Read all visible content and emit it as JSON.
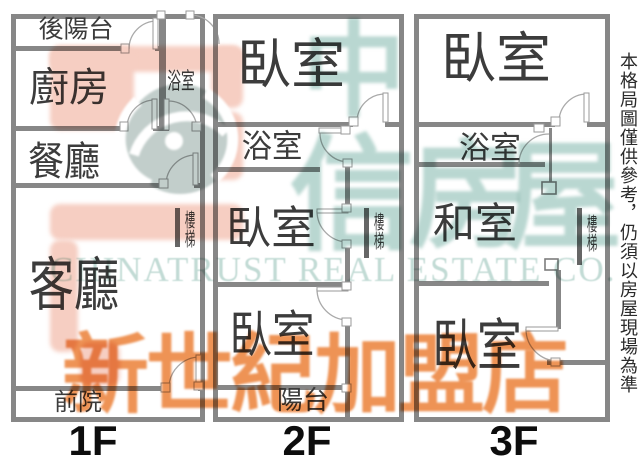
{
  "canvas": {
    "w": 638,
    "h": 460
  },
  "colors": {
    "wall": "#878787",
    "stair_bar": "#666666",
    "door_line": "#a9a9a9",
    "room_text": "#3c3c3c",
    "floor_text": "#0d0d0d",
    "pink": "#f6cec2",
    "teal_char": "#b9d7d1",
    "teal_text": "#c2dbd5",
    "globe": "#c2cecb",
    "orange": "#ee9355",
    "disclaimer_text": "#2b2b2b"
  },
  "disclaimer": {
    "text": "本格局圖僅供參考，仍須以房屋現場為準"
  },
  "watermark": {
    "english": "CHINATRUST REAL ESTATE CO.",
    "franchise": "新世紀加盟店",
    "brand_chars": [
      {
        "ch": "中",
        "x": 354,
        "y": 72,
        "size": 104
      },
      {
        "ch": "信",
        "x": 352,
        "y": 196,
        "size": 125
      },
      {
        "ch": "房",
        "x": 468,
        "y": 197,
        "size": 118
      },
      {
        "ch": "屋",
        "x": 563,
        "y": 198,
        "size": 118
      }
    ],
    "pink_shapes": [
      [
        50,
        46,
        193,
        26
      ],
      [
        50,
        46,
        84,
        84
      ],
      [
        211,
        46,
        32,
        62
      ],
      [
        211,
        112,
        32,
        68
      ],
      [
        50,
        204,
        193,
        36
      ],
      [
        50,
        240,
        28,
        112
      ],
      [
        80,
        342,
        40,
        44
      ]
    ],
    "globe": {
      "cx": 180,
      "cy": 139,
      "r": 55
    }
  },
  "floors": [
    {
      "label": "1F",
      "label_x": 93,
      "label_y": 441,
      "walls": [
        [
          11,
          14,
          194,
          5
        ],
        [
          11,
          417,
          194,
          5
        ],
        [
          11,
          14,
          5,
          408
        ],
        [
          200,
          14,
          5,
          408
        ],
        [
          11,
          46,
          117,
          5
        ],
        [
          155,
          46,
          11,
          5
        ],
        [
          159,
          14,
          7,
          117
        ],
        [
          11,
          126,
          113,
          5
        ],
        [
          153,
          126,
          16,
          5
        ],
        [
          196,
          126,
          9,
          5
        ],
        [
          11,
          183,
          152,
          5
        ],
        [
          194,
          183,
          11,
          5
        ],
        [
          11,
          386,
          155,
          5
        ],
        [
          198,
          386,
          7,
          5
        ]
      ],
      "stair_bar": [
        175,
        208,
        5,
        39
      ],
      "doors": [
        {
          "arc": [
            129,
            49,
            28,
            157,
            21,
            1
          ],
          "leaf": [
            153,
            18,
            5,
            31
          ],
          "jambs": [
            [
              121,
              44,
              8,
              9
            ]
          ]
        },
        {
          "arc": [
            190,
            15,
            29,
            219,
            44,
            1
          ],
          "jambs": [
            [
              157,
              11,
              8,
              8
            ],
            [
              186,
              11,
              8,
              8
            ]
          ]
        },
        {
          "arc": [
            127,
            128,
            28,
            155,
            100,
            1
          ],
          "leaf": [
            152,
            99,
            5,
            30
          ],
          "jambs": [
            [
              120,
              122,
              8,
              9
            ]
          ]
        },
        {
          "arc": [
            168,
            101,
            29,
            197,
            130,
            1
          ],
          "leaf": [
            164,
            99,
            5,
            31
          ],
          "jambs": [
            [
              192,
              122,
              9,
              9
            ]
          ]
        },
        {
          "arc": [
            166,
            185,
            30,
            196,
            155,
            1
          ],
          "leaf": [
            193,
            153,
            5,
            32
          ],
          "jambs": [
            [
              159,
              179,
              9,
              9
            ]
          ]
        },
        {
          "arc": [
            169,
            388,
            31,
            200,
            357,
            1
          ],
          "leaf": [
            196,
            355,
            5,
            32
          ],
          "jambs": [
            [
              161,
              383,
              9,
              9
            ],
            [
              194,
              382,
              9,
              8
            ]
          ]
        }
      ],
      "labels": [
        {
          "name": "back-balcony",
          "text": "後陽台",
          "x": 76,
          "y": 30,
          "size": 25
        },
        {
          "name": "kitchen",
          "text": "廚房",
          "x": 69,
          "y": 88,
          "size": 40
        },
        {
          "name": "bathroom",
          "text": "浴室",
          "x": 181,
          "y": 81,
          "size": 23,
          "sx": 0.6
        },
        {
          "name": "dining-room",
          "text": "餐廳",
          "x": 64,
          "y": 162,
          "size": 40,
          "sx": 0.9
        },
        {
          "name": "stairs",
          "text": "樓梯",
          "x": 189,
          "y": 229,
          "size": 19,
          "vertical": true,
          "sx": 0.55
        },
        {
          "name": "living-room",
          "text": "客廳",
          "x": 74,
          "y": 286,
          "size": 58,
          "sx": 0.78
        },
        {
          "name": "front-yard",
          "text": "前院",
          "x": 78,
          "y": 403,
          "size": 24
        }
      ]
    },
    {
      "label": "2F",
      "label_x": 307,
      "label_y": 441,
      "walls": [
        [
          213,
          14,
          191,
          5
        ],
        [
          213,
          417,
          191,
          5
        ],
        [
          213,
          14,
          5,
          408
        ],
        [
          399,
          14,
          5,
          408
        ],
        [
          213,
          122,
          140,
          5
        ],
        [
          385,
          122,
          19,
          5
        ],
        [
          213,
          167,
          107,
          5
        ],
        [
          345,
          167,
          5,
          43
        ],
        [
          345,
          246,
          5,
          42
        ],
        [
          345,
          324,
          5,
          93
        ],
        [
          218,
          282,
          131,
          5
        ],
        [
          218,
          385,
          131,
          5
        ]
      ],
      "stair_bar": [
        364,
        208,
        5,
        50
      ],
      "doors": [
        {
          "arc": [
            357,
            122,
            28,
            385,
            94,
            1
          ],
          "leaf": [
            383,
            93,
            5,
            29
          ],
          "jambs": [
            [
              349,
              117,
              9,
              9
            ]
          ]
        },
        {
          "arc": [
            320,
            133,
            29,
            349,
            162,
            0
          ],
          "leaf": [
            319,
            128,
            30,
            5
          ],
          "jambs": [
            [
              341,
              126,
              9,
              8
            ],
            [
              343,
              159,
              9,
              8
            ]
          ]
        },
        {
          "arc": [
            317,
            211,
            31,
            347,
            242,
            0
          ],
          "leaf": [
            317,
            209,
            31,
            4
          ],
          "jambs": [
            [
              342,
              204,
              9,
              8
            ],
            [
              342,
              240,
              9,
              8
            ]
          ]
        },
        {
          "arc": [
            317,
            289,
            31,
            347,
            320,
            0
          ],
          "leaf": [
            317,
            287,
            31,
            4
          ],
          "jambs": [
            [
              342,
              282,
              9,
              8
            ],
            [
              342,
              318,
              9,
              8
            ]
          ]
        },
        {
          "jambs": [
            [
              342,
              384,
              9,
              8
            ]
          ]
        }
      ],
      "labels": [
        {
          "name": "bedroom-1",
          "text": "臥室",
          "x": 291,
          "y": 65,
          "size": 54
        },
        {
          "name": "bathroom",
          "text": "浴室",
          "x": 272,
          "y": 146,
          "size": 32,
          "sx": 0.95
        },
        {
          "name": "bedroom-2",
          "text": "臥室",
          "x": 271,
          "y": 229,
          "size": 45
        },
        {
          "name": "stairs",
          "text": "樓梯",
          "x": 378,
          "y": 231,
          "size": 19,
          "vertical": true,
          "sx": 0.55
        },
        {
          "name": "bedroom-3",
          "text": "臥室",
          "x": 272,
          "y": 335,
          "size": 50,
          "sx": 0.85
        },
        {
          "name": "balcony",
          "text": "陽台",
          "x": 303,
          "y": 401,
          "size": 26
        }
      ]
    },
    {
      "label": "3F",
      "label_x": 514,
      "label_y": 441,
      "walls": [
        [
          414,
          14,
          196,
          5
        ],
        [
          414,
          417,
          196,
          5
        ],
        [
          414,
          14,
          5,
          408
        ],
        [
          605,
          14,
          5,
          408
        ],
        [
          414,
          122,
          141,
          5
        ],
        [
          587,
          122,
          23,
          5
        ],
        [
          414,
          162,
          131,
          5
        ],
        [
          414,
          281,
          135,
          5
        ],
        [
          547,
          360,
          63,
          5
        ],
        [
          556,
          270,
          5,
          59
        ]
      ],
      "thin_walls": [
        [
          549,
          128,
          3,
          55
        ]
      ],
      "posts": [
        [
          542,
          182,
          14,
          12
        ],
        [
          545,
          259,
          13,
          11
        ]
      ],
      "stair_bar": [
        577,
        208,
        5,
        57
      ],
      "doors": [
        {
          "arc": [
            559,
            122,
            28,
            587,
            94,
            1
          ],
          "leaf": [
            584,
            93,
            5,
            29
          ],
          "jambs": [
            [
              551,
              117,
              9,
              9
            ]
          ]
        },
        {
          "arc": [
            519,
            164,
            30,
            549,
            134,
            1
          ],
          "jambs": [
            [
              534,
              124,
              10,
              8
            ]
          ]
        },
        {
          "arc": [
            526,
            329,
            32,
            558,
            361,
            0
          ],
          "leaf": [
            526,
            327,
            32,
            4
          ],
          "jambs": [
            [
              551,
              358,
              9,
              8
            ]
          ]
        }
      ],
      "labels": [
        {
          "name": "bedroom-1",
          "text": "臥室",
          "x": 496,
          "y": 59,
          "size": 55
        },
        {
          "name": "bathroom",
          "text": "浴室",
          "x": 490,
          "y": 148,
          "size": 31
        },
        {
          "name": "washitsu",
          "text": "和室",
          "x": 475,
          "y": 225,
          "size": 42
        },
        {
          "name": "stairs",
          "text": "樓梯",
          "x": 591,
          "y": 233,
          "size": 19,
          "vertical": true,
          "sx": 0.55
        },
        {
          "name": "bedroom-2",
          "text": "臥室",
          "x": 477,
          "y": 347,
          "size": 56,
          "sx": 0.8
        }
      ]
    }
  ]
}
